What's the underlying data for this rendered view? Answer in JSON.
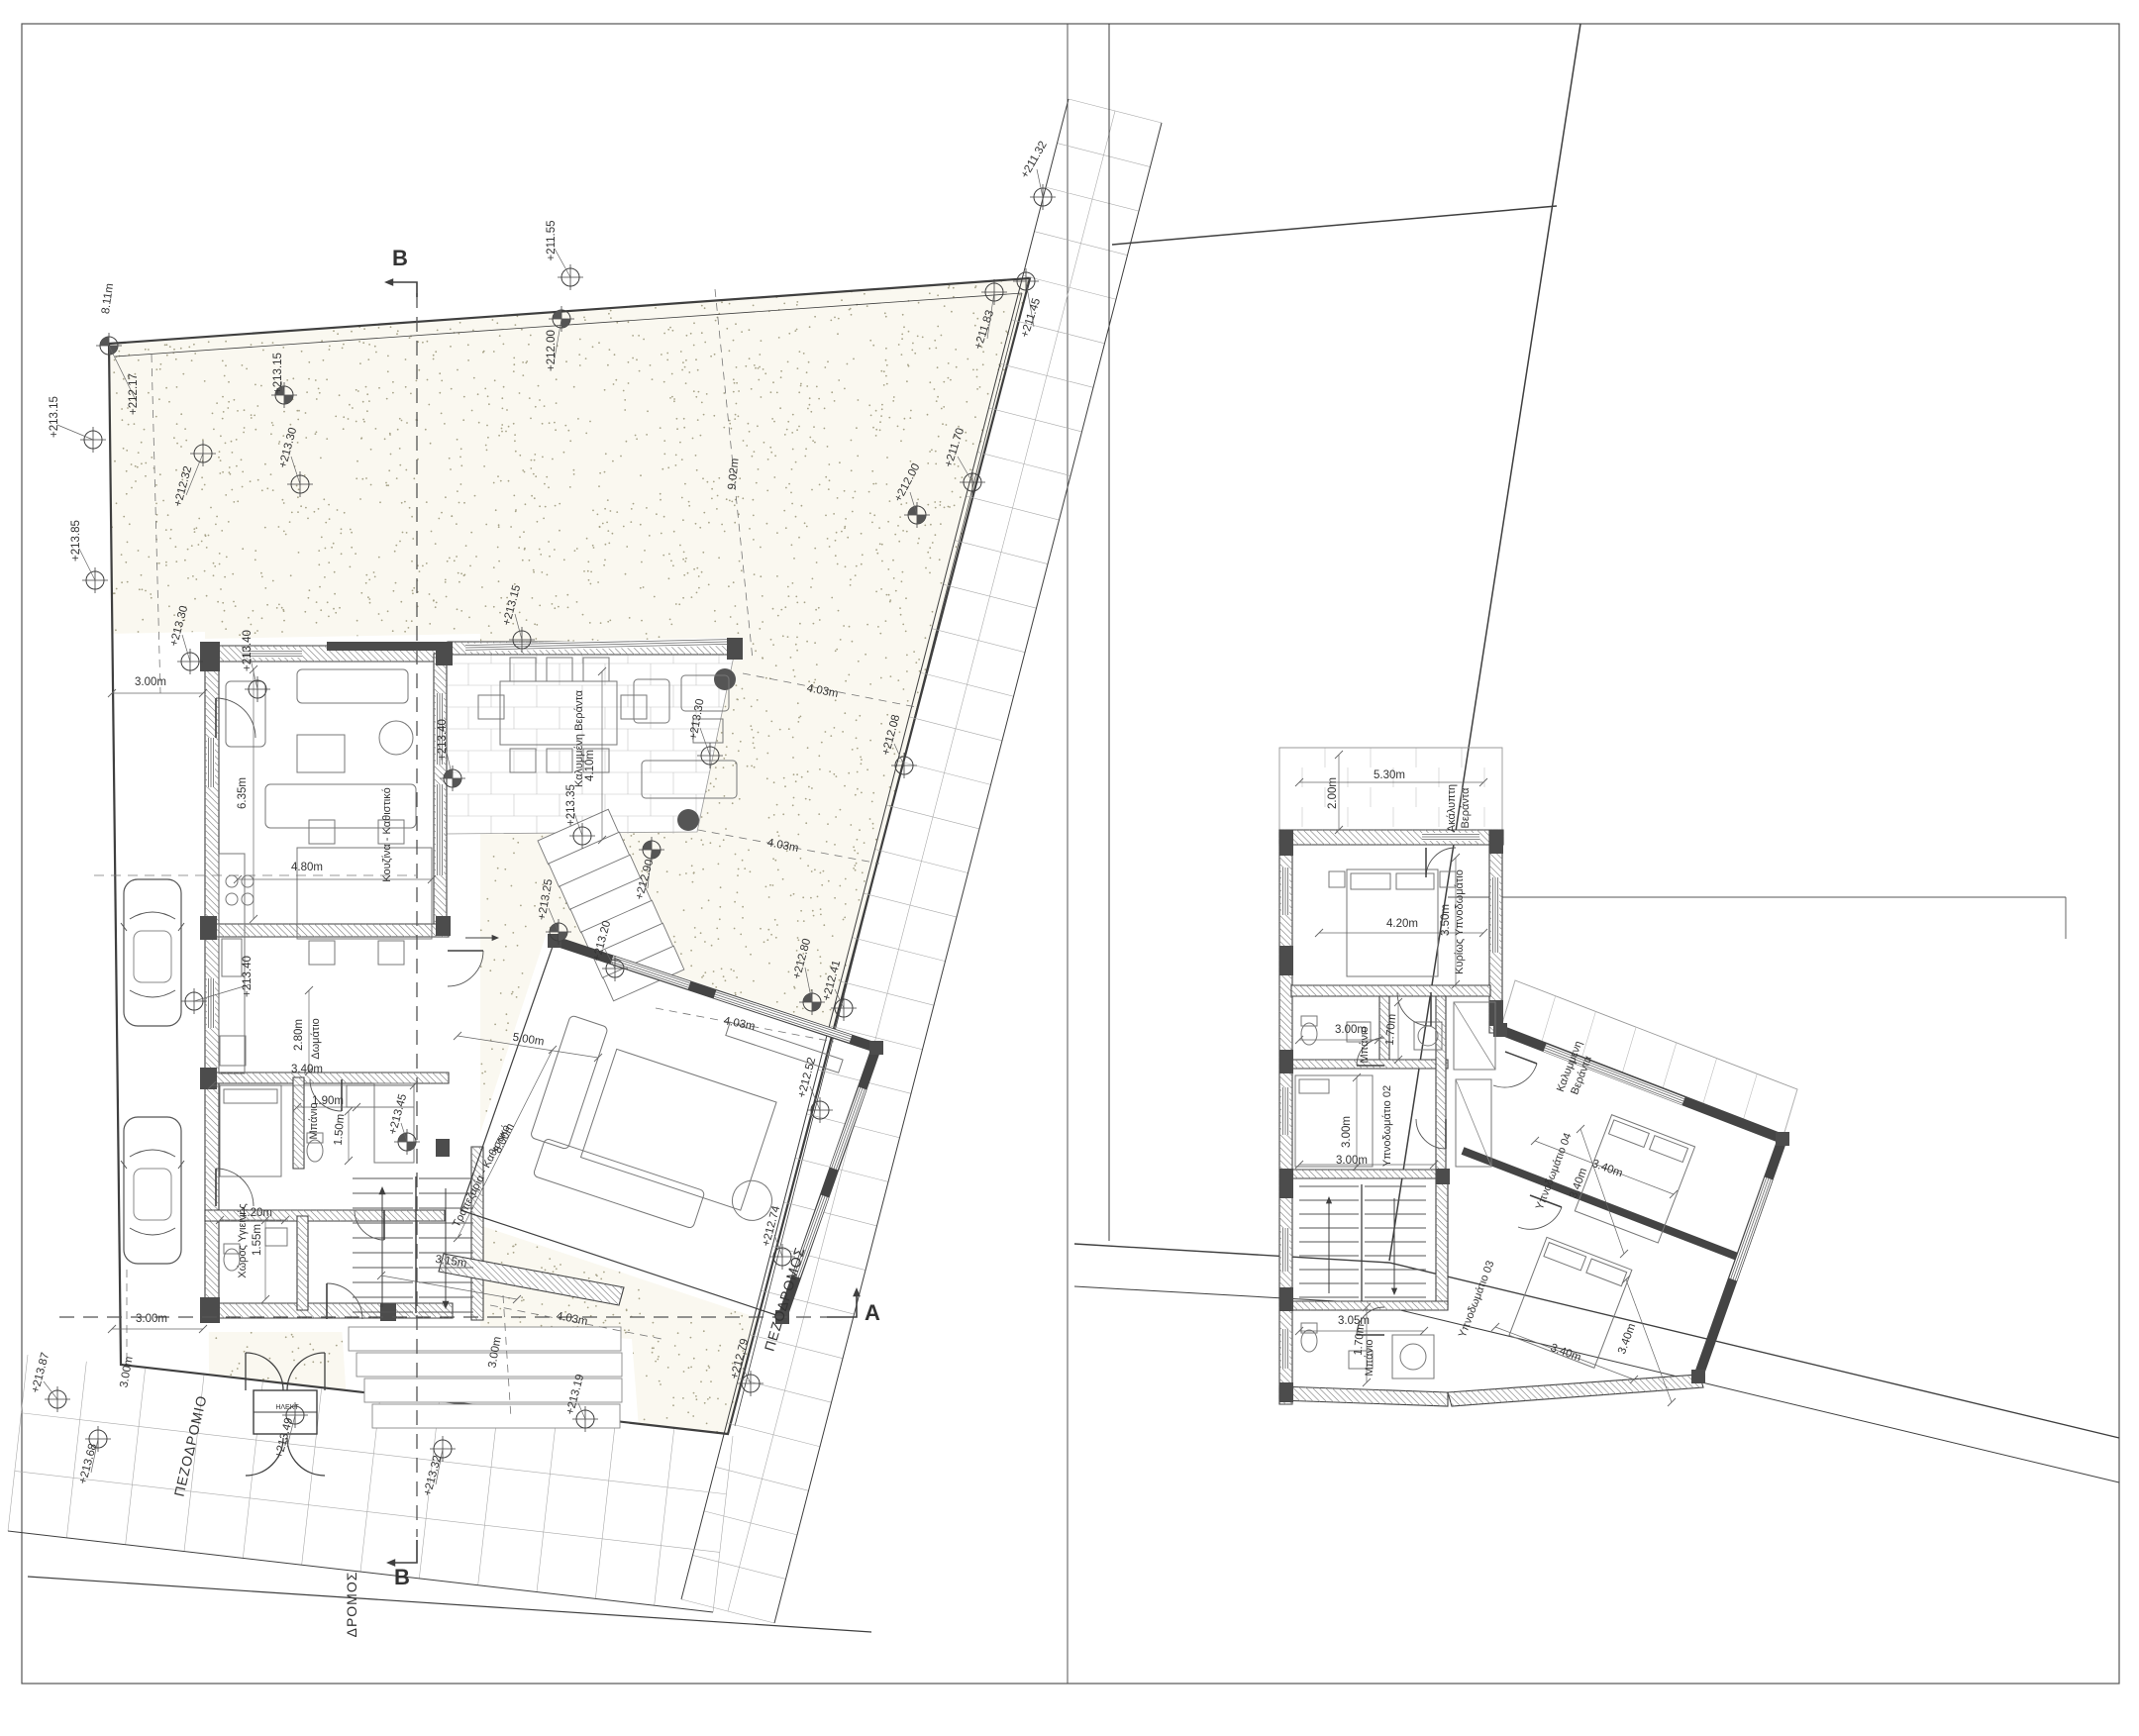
{
  "sheet": {
    "type": "architectural floor plans",
    "panels": {
      "left": "ground floor / site plan",
      "right": "upper floor plan"
    }
  },
  "colors": {
    "line": "#3f3f3f",
    "light_line": "#8a8a8a",
    "stipple": "#a7a389",
    "garden_bg": "#faf8f0",
    "pier": "#4c4c4c",
    "tile": "#c4c4c4",
    "text": "#333333",
    "white": "#ffffff"
  },
  "left_plan": {
    "elevations": [
      [
        "+212.17",
        138,
        398,
        -90,
        110,
        349,
        1
      ],
      [
        "+212.32",
        188,
        492,
        -75,
        205,
        458,
        0
      ],
      [
        "+211.55",
        560,
        243,
        -90,
        576,
        280,
        0
      ],
      [
        "+212.00",
        560,
        354,
        -90,
        567,
        322,
        1
      ],
      [
        "+211.32",
        1047,
        163,
        -60,
        1053,
        199,
        0
      ],
      [
        "+211.45",
        1044,
        322,
        -72,
        1036,
        284,
        0
      ],
      [
        "+211.83",
        997,
        334,
        -72,
        1004,
        295,
        0
      ],
      [
        "+211.70",
        967,
        453,
        -72,
        982,
        487,
        0
      ],
      [
        "+212.00",
        919,
        489,
        -62,
        926,
        520,
        1
      ],
      [
        "+212.08",
        903,
        743,
        -75,
        913,
        773,
        0
      ],
      [
        "+212.90",
        654,
        889,
        -75,
        658,
        858,
        1
      ],
      [
        "+213.15",
        284,
        377,
        -90,
        287,
        399,
        1
      ],
      [
        "+213.30",
        294,
        453,
        -75,
        303,
        489,
        0
      ],
      [
        "+213.15",
        520,
        612,
        -75,
        527,
        646,
        0
      ],
      [
        "+213.30",
        707,
        727,
        -80,
        717,
        763,
        0
      ],
      [
        "+213.35",
        580,
        813,
        -90,
        588,
        844,
        0
      ],
      [
        "+213.20",
        611,
        951,
        -75,
        621,
        978,
        0
      ],
      [
        "+213.25",
        554,
        909,
        -80,
        564,
        941,
        1
      ],
      [
        "+213.85",
        80,
        546,
        -90,
        96,
        586,
        0
      ],
      [
        "+213.15",
        58,
        421,
        -90,
        94,
        444,
        0
      ],
      [
        "+213.30",
        184,
        633,
        -75,
        192,
        668,
        0
      ],
      [
        "+213.40",
        253,
        657,
        -90,
        260,
        696,
        0
      ],
      [
        "+213.40",
        253,
        986,
        -90,
        196,
        1011,
        0
      ],
      [
        "+213.40",
        450,
        747,
        -90,
        457,
        786,
        1
      ],
      [
        "+213.45",
        405,
        1126,
        -75,
        411,
        1153,
        1
      ],
      [
        "+212.80",
        813,
        969,
        -75,
        820,
        1012,
        1
      ],
      [
        "+212.41",
        843,
        991,
        -75,
        852,
        1018,
        0
      ],
      [
        "+212.52",
        818,
        1089,
        -75,
        828,
        1121,
        0
      ],
      [
        "+212.74",
        782,
        1239,
        -75,
        790,
        1269,
        0
      ],
      [
        "+212.79",
        750,
        1373,
        -75,
        758,
        1397,
        0
      ],
      [
        "+213.49",
        290,
        1453,
        -75,
        298,
        1429,
        0
      ],
      [
        "+213.32",
        440,
        1491,
        -75,
        447,
        1463,
        0
      ],
      [
        "+213.19",
        584,
        1409,
        -75,
        591,
        1433,
        0
      ],
      [
        "+213.87",
        44,
        1387,
        -75,
        58,
        1413,
        0
      ],
      [
        "+213.68",
        92,
        1479,
        -75,
        99,
        1453,
        0
      ]
    ],
    "dims": [
      [
        "3.00m",
        152,
        692,
        0
      ],
      [
        "8.11m",
        112,
        302,
        -82
      ],
      [
        "9.02m",
        744,
        479,
        -84
      ],
      [
        "4.03m",
        830,
        701,
        11
      ],
      [
        "4.03m",
        790,
        857,
        11
      ],
      [
        "4.03m",
        746,
        1037,
        11
      ],
      [
        "4.03m",
        577,
        1335,
        11
      ],
      [
        "6.35m",
        248,
        801,
        -90
      ],
      [
        "4.80m",
        310,
        879,
        0
      ],
      [
        "4.10m",
        599,
        773,
        -90
      ],
      [
        "2.80m",
        305,
        1045,
        -90
      ],
      [
        "3.40m",
        310,
        1083,
        0
      ],
      [
        "1.90m",
        331,
        1115,
        0
      ],
      [
        "1.50m",
        346,
        1141,
        -85
      ],
      [
        "1.20m",
        259,
        1228,
        0
      ],
      [
        "1.55m",
        263,
        1252,
        -90
      ],
      [
        "5.00m",
        533,
        1053,
        9
      ],
      [
        "8.00m",
        512,
        1151,
        -63
      ],
      [
        "3.15m",
        455,
        1277,
        8
      ],
      [
        "3.00m",
        153,
        1335,
        0
      ],
      [
        "3.00m",
        131,
        1386,
        -80
      ],
      [
        "3.00m",
        503,
        1366,
        -80
      ]
    ],
    "rooms": [
      [
        "Κουζίνα - Καθιστικό",
        394,
        843,
        -90
      ],
      [
        "Καλυμμένη Βεράντα",
        588,
        746,
        -90
      ],
      [
        "Τραπεζαρία - Καθιστικό",
        489,
        1189,
        -63
      ],
      [
        "Δωμάτιο",
        322,
        1049,
        -90
      ],
      [
        "Μπάνιο",
        320,
        1132,
        -90
      ],
      [
        "Χώρος Υγιεινής",
        248,
        1253,
        -90
      ],
      [
        "ΗΛΕΚΤ",
        290,
        1423,
        0
      ]
    ],
    "streets": [
      [
        "ΠΕΖΟΔΡΟΜΙΟ",
        197,
        1461,
        -77
      ],
      [
        "ΔΡΟΜΟΣ",
        360,
        1620,
        -90
      ],
      [
        "ΠΕΖΟΔΡΟΜΟΣ",
        797,
        1313,
        -73
      ]
    ],
    "sections": [
      [
        "B",
        404,
        268
      ],
      [
        "B",
        406,
        1600
      ],
      [
        "A",
        881,
        1333
      ]
    ]
  },
  "right_plan": {
    "dims": [
      [
        "5.30m",
        1403,
        786,
        0
      ],
      [
        "2.00m",
        1349,
        801,
        -90
      ],
      [
        "4.20m",
        1416,
        936,
        0
      ],
      [
        "3.50m",
        1463,
        929,
        -90
      ],
      [
        "3.00m",
        1364,
        1043,
        0
      ],
      [
        "1.70m",
        1408,
        1040,
        -85
      ],
      [
        "3.00m",
        1363,
        1143,
        -90
      ],
      [
        "3.00m",
        1365,
        1175,
        0
      ],
      [
        "3.40m",
        1622,
        1183,
        20
      ],
      [
        "3.40m",
        1597,
        1196,
        -70
      ],
      [
        "3.40m",
        1580,
        1369,
        20
      ],
      [
        "3.40m",
        1646,
        1353,
        -70
      ],
      [
        "3.05m",
        1367,
        1337,
        0
      ],
      [
        "1.70m",
        1376,
        1353,
        -85
      ]
    ],
    "rooms": [
      [
        "Ακάλυπτη",
        1469,
        816,
        -90
      ],
      [
        "Βεράντα",
        1483,
        816,
        -90
      ],
      [
        "Κυρίως Υπνοδωμάτιο",
        1477,
        931,
        -90
      ],
      [
        "Μπάνιο",
        1381,
        1055,
        -90
      ],
      [
        "Υπνοδωμάτιο 02",
        1404,
        1137,
        -90
      ],
      [
        "Καλυμμένη",
        1588,
        1078,
        -69
      ],
      [
        "Βεράντα",
        1600,
        1087,
        -69
      ],
      [
        "Υπνοδωμάτιο 04",
        1572,
        1184,
        -69
      ],
      [
        "Υπνοδωμάτιο 03",
        1494,
        1313,
        -69
      ],
      [
        "Μπάνιο",
        1386,
        1371,
        -90
      ]
    ]
  }
}
